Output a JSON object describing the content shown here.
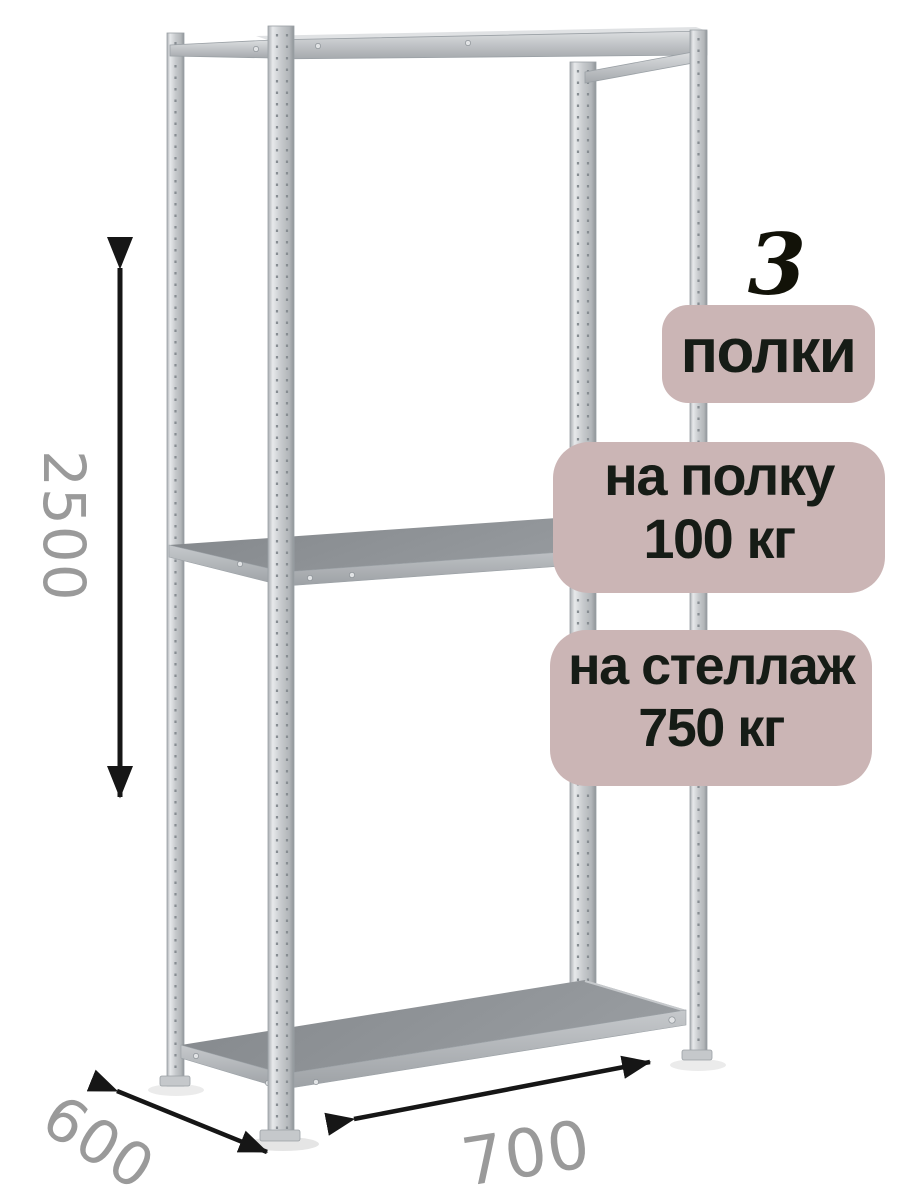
{
  "product": {
    "name": "metal-shelving-rack"
  },
  "badges": {
    "count": "3",
    "count_label": "полки",
    "per_shelf": {
      "line1": "на полку",
      "line2": "100 кг"
    },
    "per_rack": {
      "line1": "на стеллаж",
      "line2": "750 кг"
    }
  },
  "dimensions": {
    "height_mm": "2500",
    "depth_mm": "600",
    "width_mm": "700"
  },
  "colors": {
    "badge_bg": "#cbb5b5",
    "badge_text": "#161c16",
    "count_text": "#121208",
    "dimension_text": "#9a9a9a",
    "arrow": "#161616"
  }
}
